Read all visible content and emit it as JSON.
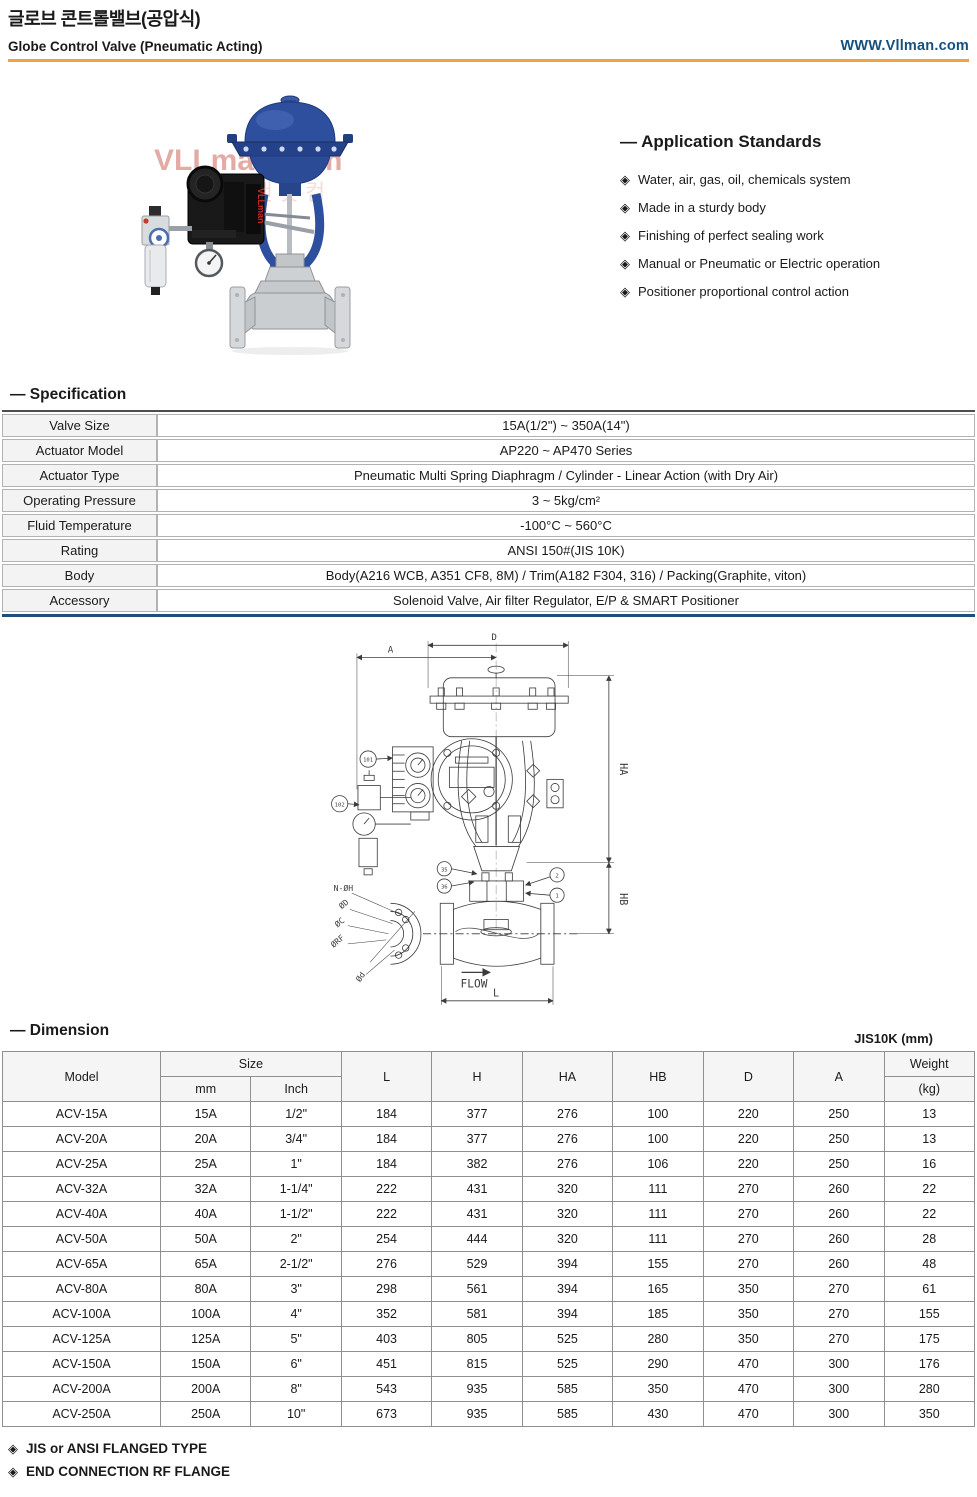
{
  "icons": {
    "bullet": "◈"
  },
  "header": {
    "title_ko": "글로브 콘트롤밸브(공압식)",
    "title_en": "Globe Control Valve (Pneumatic Acting)",
    "website": "WWW.Vllman.com",
    "accent_color": "#f2a23c",
    "website_color": "#17507e"
  },
  "photo": {
    "watermark": "VLLman.com",
    "watermark_ko": "밸브맨닷컴",
    "brand_label": "VLLman"
  },
  "application_standards": {
    "title": "— Application Standards",
    "items": [
      "Water, air, gas, oil, chemicals system",
      "Made in a sturdy body",
      "Finishing of perfect sealing work",
      "Manual or Pneumatic or Electric operation",
      "Positioner proportional control action"
    ]
  },
  "specification": {
    "title": "— Specification",
    "rows": [
      {
        "label": "Valve Size",
        "value": "15A(1/2\") ~ 350A(14\")"
      },
      {
        "label": "Actuator Model",
        "value": "AP220 ~ AP470 Series"
      },
      {
        "label": "Actuator Type",
        "value": "Pneumatic Multi Spring Diaphragm / Cylinder - Linear Action (with Dry Air)"
      },
      {
        "label": "Operating Pressure",
        "value": "3 ~ 5kg/cm²"
      },
      {
        "label": "Fluid Temperature",
        "value": "-100°C ~ 560°C"
      },
      {
        "label": "Rating",
        "value": "ANSI 150#(JIS 10K)"
      },
      {
        "label": "Body",
        "value": "Body(A216 WCB, A351 CF8, 8M) / Trim(A182 F304, 316) / Packing(Graphite, viton)"
      },
      {
        "label": "Accessory",
        "value": "Solenoid Valve, Air filter Regulator, E/P & SMART Positioner"
      }
    ]
  },
  "drawing": {
    "labels": {
      "A": "A",
      "D": "D",
      "HA": "HA",
      "HB": "HB",
      "L": "L",
      "flow": "FLOW",
      "n_oh": "N-ØH",
      "od": "ØD",
      "oc": "ØC",
      "orf": "ØRF",
      "od_small": "Ød"
    },
    "callouts": {
      "c101": "101",
      "c102": "102",
      "c35": "35",
      "c36": "36",
      "c2": "2",
      "c1": "1"
    }
  },
  "dimension": {
    "title": "— Dimension",
    "unit_note": "JIS10K (mm)",
    "columns": {
      "model": "Model",
      "size": "Size",
      "mm": "mm",
      "inch": "Inch",
      "l": "L",
      "h": "H",
      "ha": "HA",
      "hb": "HB",
      "d": "D",
      "a": "A",
      "weight": "Weight",
      "weight_unit": "(kg)"
    },
    "rows": [
      [
        "ACV-15A",
        "15A",
        "1/2\"",
        "184",
        "377",
        "276",
        "100",
        "220",
        "250",
        "13"
      ],
      [
        "ACV-20A",
        "20A",
        "3/4\"",
        "184",
        "377",
        "276",
        "100",
        "220",
        "250",
        "13"
      ],
      [
        "ACV-25A",
        "25A",
        "1\"",
        "184",
        "382",
        "276",
        "106",
        "220",
        "250",
        "16"
      ],
      [
        "ACV-32A",
        "32A",
        "1-1/4\"",
        "222",
        "431",
        "320",
        "111",
        "270",
        "260",
        "22"
      ],
      [
        "ACV-40A",
        "40A",
        "1-1/2\"",
        "222",
        "431",
        "320",
        "111",
        "270",
        "260",
        "22"
      ],
      [
        "ACV-50A",
        "50A",
        "2\"",
        "254",
        "444",
        "320",
        "111",
        "270",
        "260",
        "28"
      ],
      [
        "ACV-65A",
        "65A",
        "2-1/2\"",
        "276",
        "529",
        "394",
        "155",
        "270",
        "260",
        "48"
      ],
      [
        "ACV-80A",
        "80A",
        "3\"",
        "298",
        "561",
        "394",
        "165",
        "350",
        "270",
        "61"
      ],
      [
        "ACV-100A",
        "100A",
        "4\"",
        "352",
        "581",
        "394",
        "185",
        "350",
        "270",
        "155"
      ],
      [
        "ACV-125A",
        "125A",
        "5\"",
        "403",
        "805",
        "525",
        "280",
        "350",
        "270",
        "175"
      ],
      [
        "ACV-150A",
        "150A",
        "6\"",
        "451",
        "815",
        "525",
        "290",
        "470",
        "300",
        "176"
      ],
      [
        "ACV-200A",
        "200A",
        "8\"",
        "543",
        "935",
        "585",
        "350",
        "470",
        "300",
        "280"
      ],
      [
        "ACV-250A",
        "250A",
        "10\"",
        "673",
        "935",
        "585",
        "430",
        "470",
        "300",
        "350"
      ]
    ]
  },
  "footnotes": [
    "JIS or ANSI FLANGED TYPE",
    "END CONNECTION  RF FLANGE"
  ]
}
